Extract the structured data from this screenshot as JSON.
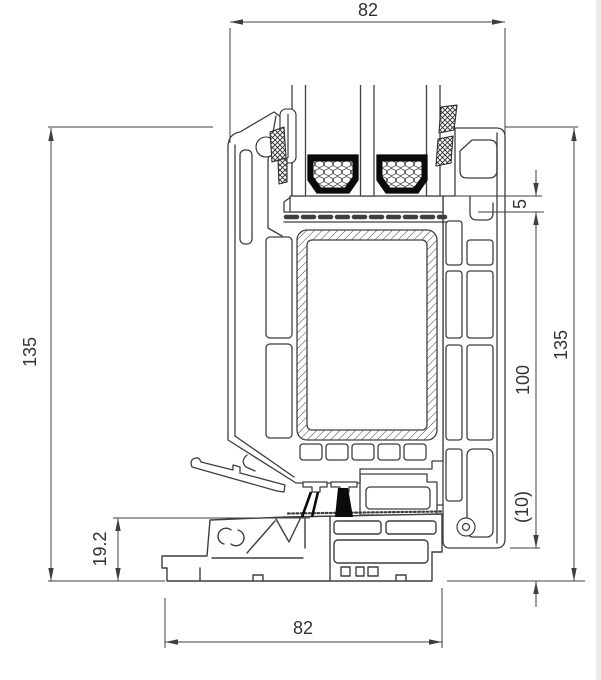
{
  "drawing": {
    "colors": {
      "line": "#3f3f3f",
      "text": "#333333",
      "seal": "#0b0b0b",
      "background": "#ffffff"
    },
    "dimensions": {
      "top_width": "82",
      "left_overall_height": "135",
      "right_overall_height": "135",
      "frame_height": "100",
      "glazing_edge_cover": "5",
      "clearance": "(10)",
      "threshold_height": "19.2",
      "bottom_width": "82"
    }
  }
}
